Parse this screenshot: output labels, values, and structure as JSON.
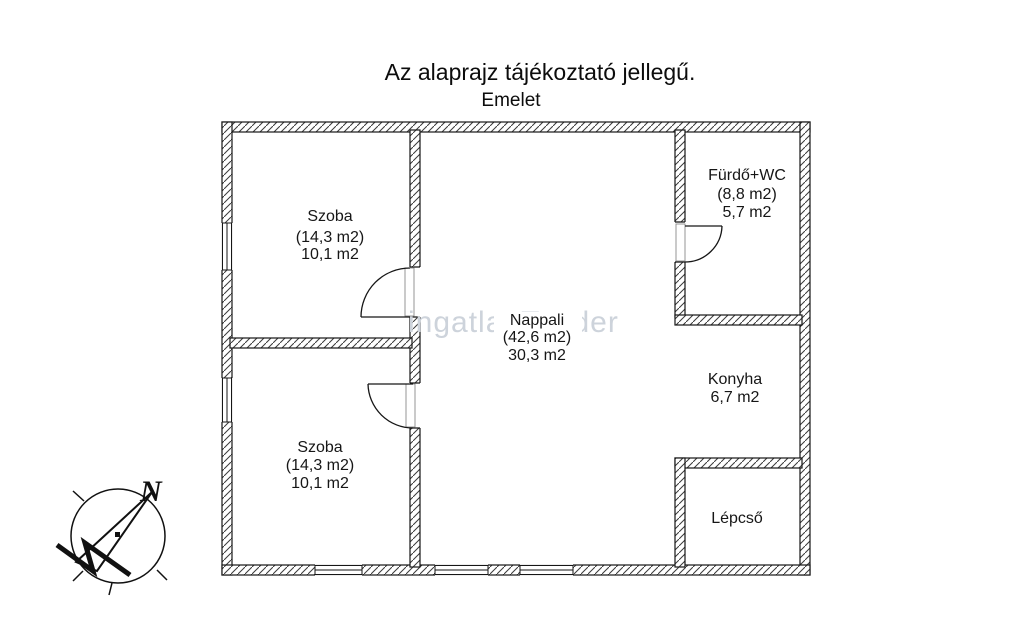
{
  "title": "Az alaprajz tájékoztató jellegű.",
  "floor_label": "Emelet",
  "watermark": "ingatlanTender",
  "compass": {
    "north_label": "N"
  },
  "rooms": {
    "szoba_top": {
      "name": "Szoba",
      "gross": "(14,3 m2)",
      "net": "10,1 m2"
    },
    "szoba_bottom": {
      "name": "Szoba",
      "gross": "(14,3 m2)",
      "net": "10,1 m2"
    },
    "nappali": {
      "name": "Nappali",
      "gross": "(42,6 m2)",
      "net": "30,3 m2"
    },
    "furdo_wc": {
      "name": "Fürdő+WC",
      "gross": "(8,8 m2)",
      "net": "5,7 m2"
    },
    "konyha": {
      "name": "Konyha",
      "net": "6,7 m2"
    },
    "lepcso": {
      "name": "Lépcső"
    }
  },
  "colors": {
    "wall_line": "#161616",
    "hatch": "#3a3a3a",
    "watermark": "#cdd3db",
    "background": "#ffffff"
  }
}
